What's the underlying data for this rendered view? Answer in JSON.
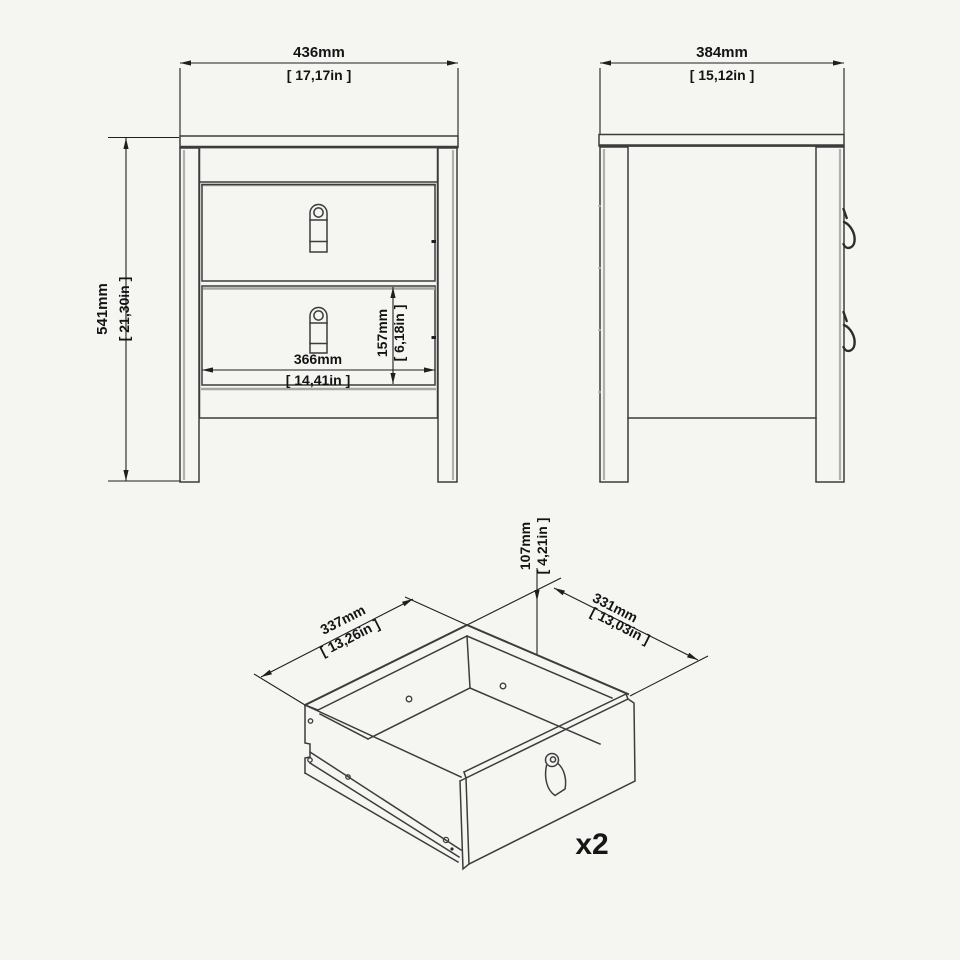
{
  "diagram": {
    "front_view": {
      "width_mm": "436mm",
      "width_in": "[ 17,17in ]",
      "height_mm": "541mm",
      "height_in": "[ 21,30in ]",
      "drawer_width_mm": "366mm",
      "drawer_width_in": "[ 14,41in ]",
      "drawer_height_mm": "157mm",
      "drawer_height_in": "[ 6,18in ]"
    },
    "side_view": {
      "depth_mm": "384mm",
      "depth_in": "[ 15,12in ]"
    },
    "drawer_view": {
      "depth_mm": "337mm",
      "depth_in": "[ 13,26in ]",
      "width_mm": "331mm",
      "width_in": "[ 13,03in ]",
      "height_mm": "107mm",
      "height_in": "[ 4,21in ]",
      "quantity": "x2"
    },
    "colors": {
      "background": "#f5f5f2",
      "line": "#3c3c3c",
      "dimension": "#1f1f1f"
    }
  }
}
